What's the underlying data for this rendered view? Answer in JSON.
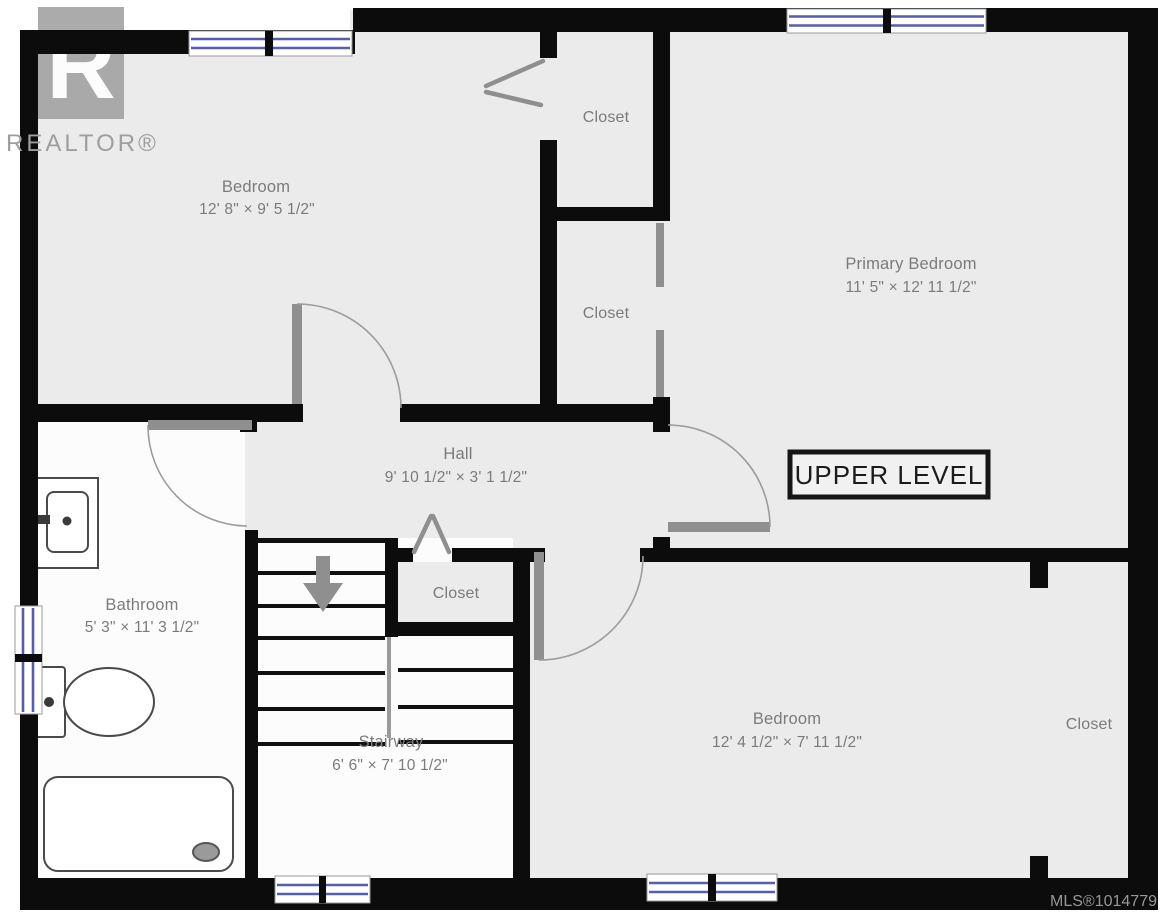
{
  "branding": {
    "logo_letter": "R",
    "logo_text": "REALTOR®"
  },
  "plan": {
    "level_label": "UPPER LEVEL",
    "mls_label": "MLS®1014779",
    "rooms": [
      {
        "id": "bedroom-upper-left",
        "name": "Bedroom",
        "dims": "12' 8\" × 9' 5 1/2\""
      },
      {
        "id": "closet-top",
        "name": "Closet",
        "dims": ""
      },
      {
        "id": "primary-bedroom",
        "name": "Primary Bedroom",
        "dims": "11' 5\" × 12' 11 1/2\""
      },
      {
        "id": "closet-middle",
        "name": "Closet",
        "dims": ""
      },
      {
        "id": "hall",
        "name": "Hall",
        "dims": "9' 10 1/2\" × 3' 1 1/2\""
      },
      {
        "id": "bathroom",
        "name": "Bathroom",
        "dims": "5' 3\" × 11' 3 1/2\""
      },
      {
        "id": "closet-stairs",
        "name": "Closet",
        "dims": ""
      },
      {
        "id": "stairway",
        "name": "Stairway",
        "dims": "6' 6\" × 7' 10 1/2\""
      },
      {
        "id": "bedroom-lower",
        "name": "Bedroom",
        "dims": "12' 4 1/2\" × 7' 11 1/2\""
      },
      {
        "id": "closet-lower-right",
        "name": "Closet",
        "dims": ""
      }
    ]
  },
  "colors": {
    "wall": "#0c0c0c",
    "floor": "#ebebeb",
    "room_white": "#fcfcfc",
    "label_gray": "#7b7b7b",
    "door_gray": "#8f8f8f",
    "window_blue": "#565cb2"
  }
}
